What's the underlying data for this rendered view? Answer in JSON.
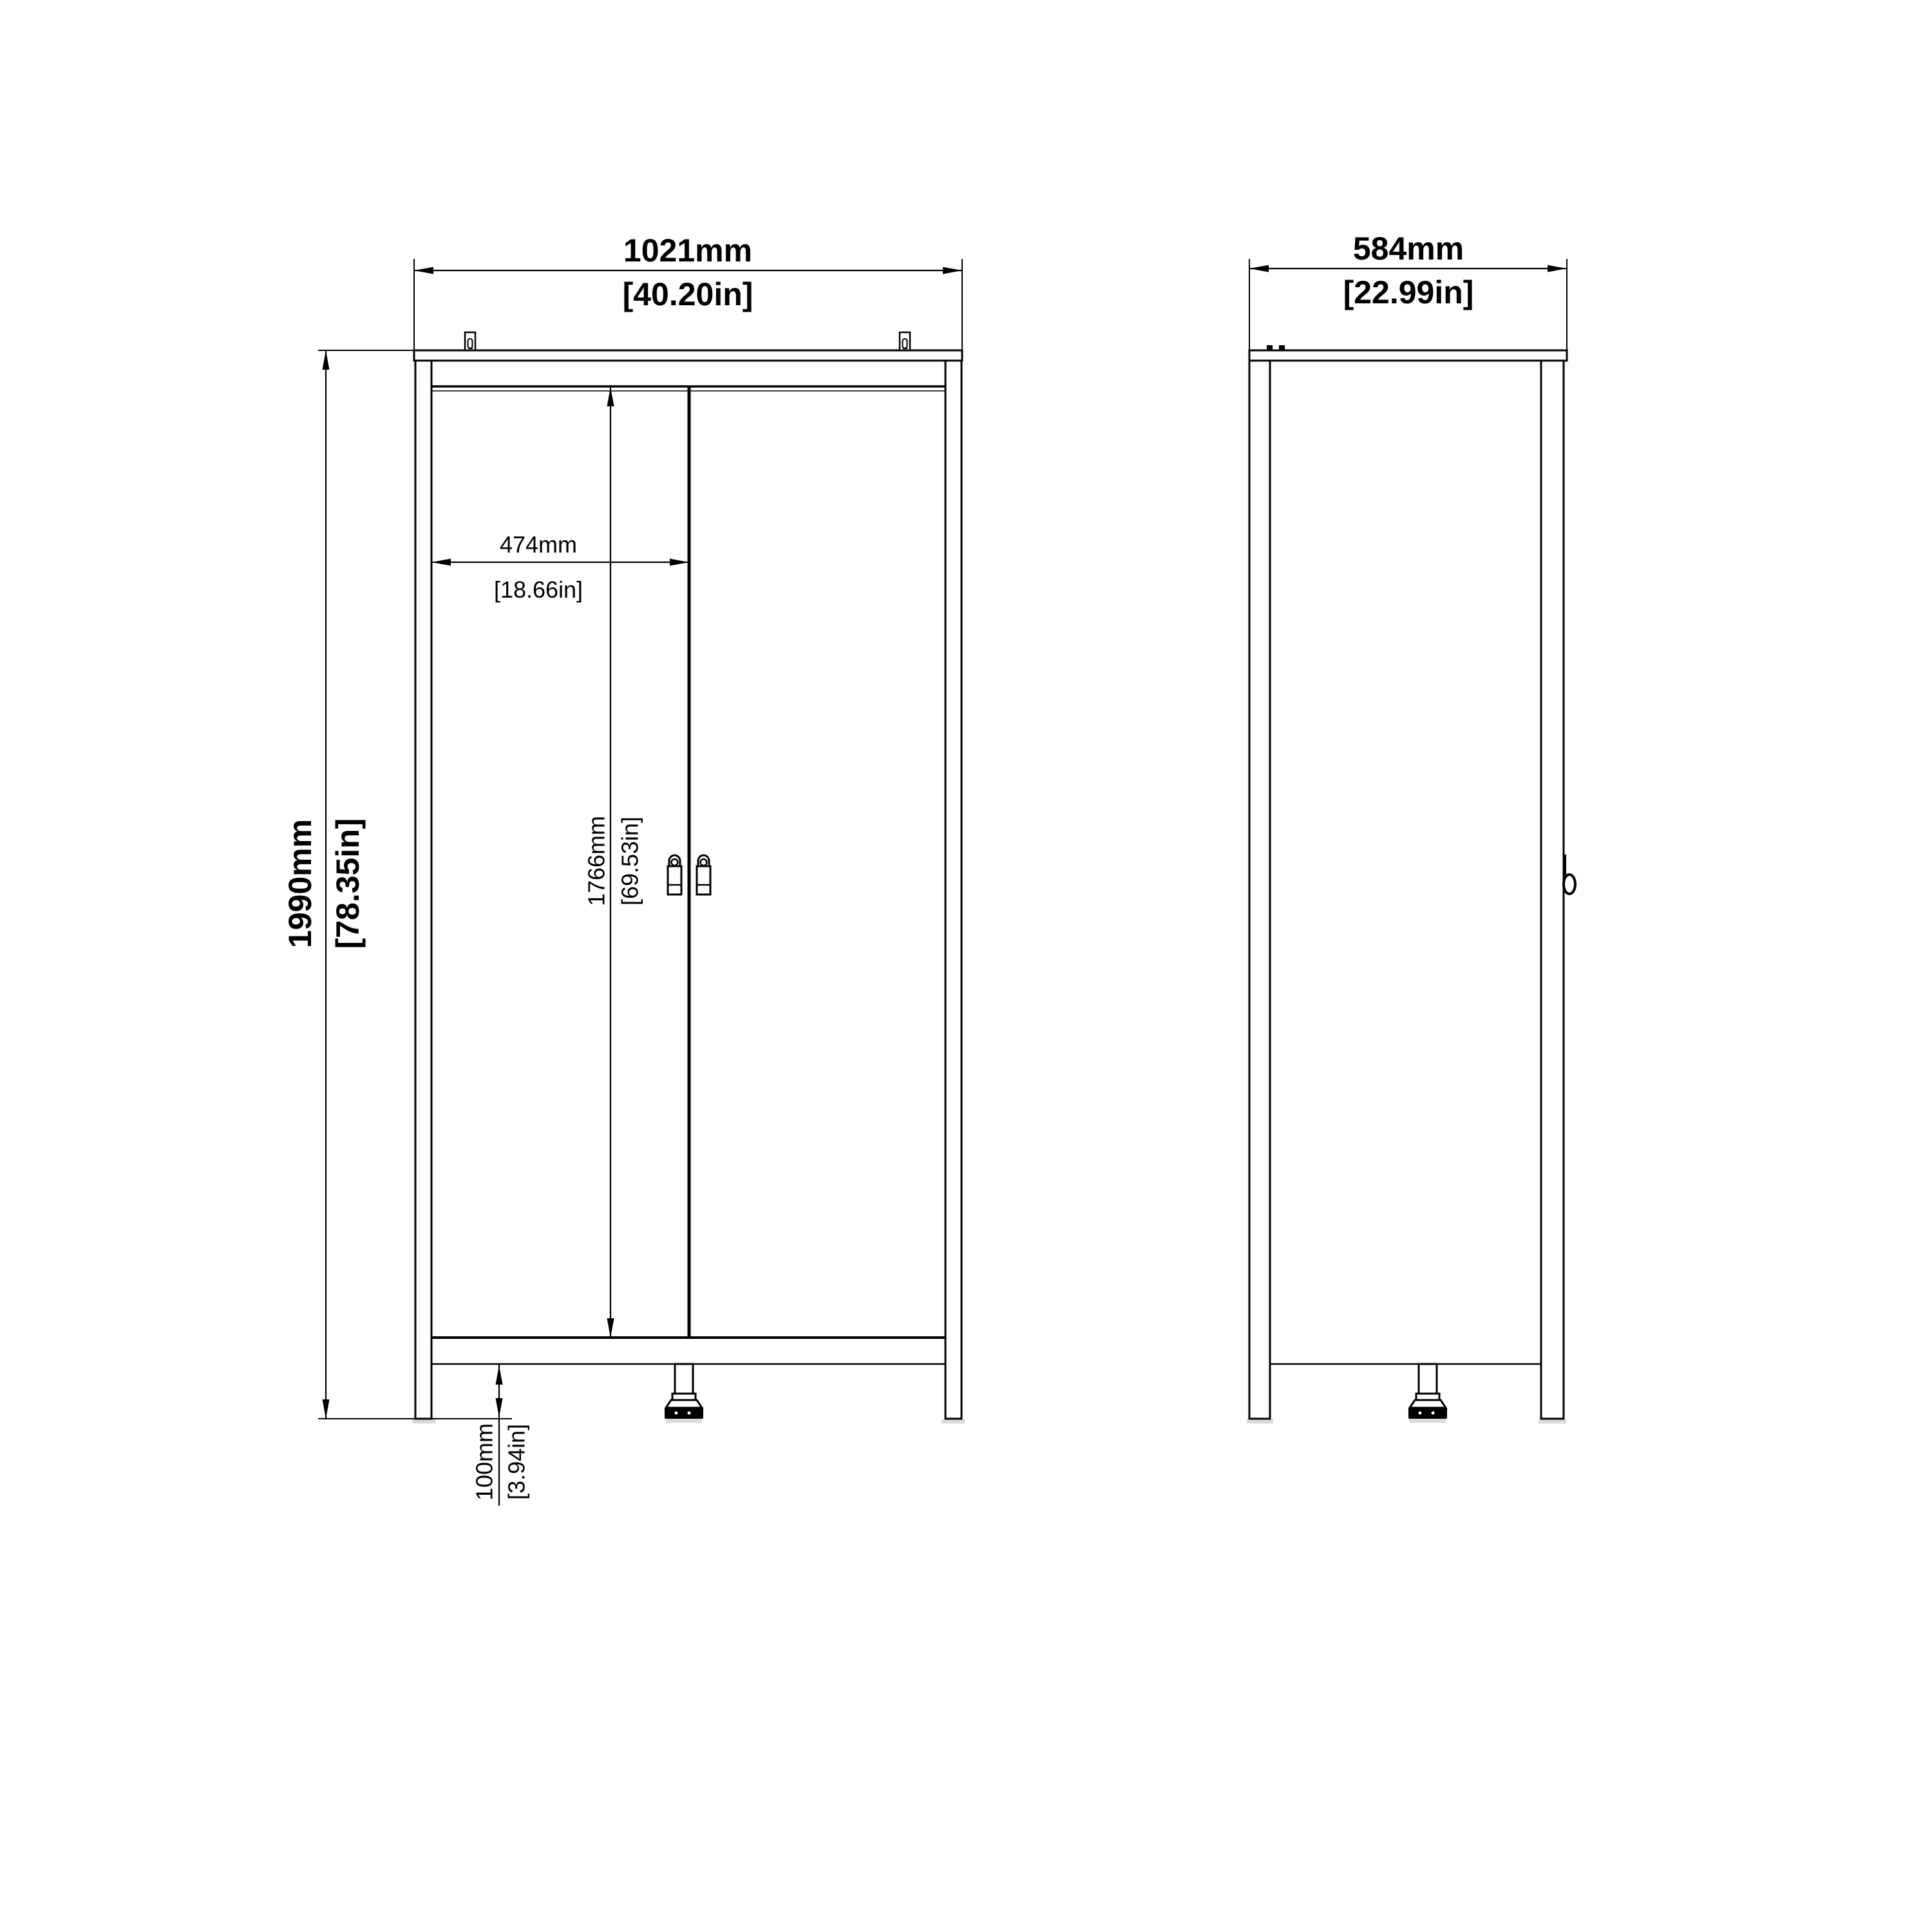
{
  "drawing": {
    "type": "furniture-dimension-drawing",
    "subject": "two-door wardrobe",
    "views": {
      "front": "front elevation",
      "side": "side elevation"
    },
    "colors": {
      "line": "#000000",
      "background": "#ffffff",
      "shadow": "#c9c9c9"
    },
    "dimensions": {
      "front_width": {
        "mm": 1021,
        "inches": 40.2,
        "label_mm": "1021mm",
        "label_in": "[40.20in]"
      },
      "front_height": {
        "mm": 1990,
        "inches": 78.35,
        "label_mm": "1990mm",
        "label_in": "[78.35in]"
      },
      "door_width": {
        "mm": 474,
        "inches": 18.66,
        "label_mm": "474mm",
        "label_in": "[18.66in]"
      },
      "door_height": {
        "mm": 1766,
        "inches": 69.53,
        "label_mm": "1766mm",
        "label_in": "[69.53in]"
      },
      "base_clearance": {
        "mm": 100,
        "inches": 3.94,
        "label_mm": "100mm",
        "label_in": "[3.94in]"
      },
      "side_depth": {
        "mm": 584,
        "inches": 22.99,
        "label_mm": "584mm",
        "label_in": "[22.99in]"
      }
    }
  }
}
